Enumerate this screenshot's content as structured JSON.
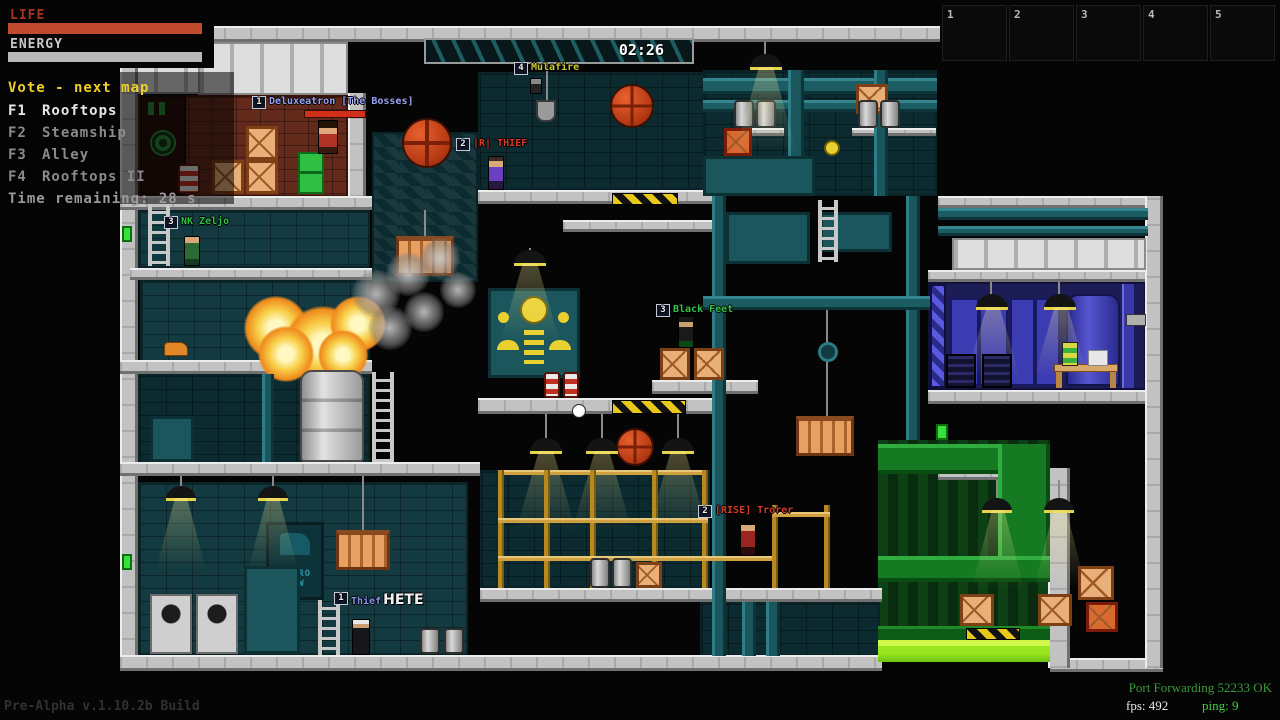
{
  "hud": {
    "life_label": "LIFE",
    "energy_label": "ENERGY",
    "timer": "02:26",
    "slots": [
      "1",
      "2",
      "3",
      "4",
      "5"
    ],
    "colors": {
      "life_bar": "#bf4a2e",
      "energy_bar": "#b9b9b9",
      "vote_title": "#f0d028",
      "acid_green": "#9ae620",
      "machine_teal": "#1a565c"
    }
  },
  "vote_menu": {
    "title": "Vote - next map",
    "options": [
      {
        "key": "F1",
        "label": "Rooftops"
      },
      {
        "key": "F2",
        "label": "Steamship"
      },
      {
        "key": "F3",
        "label": "Alley"
      },
      {
        "key": "F4",
        "label": "Rooftops II"
      }
    ],
    "time_remaining": "Time remaining: 28 s"
  },
  "players": [
    {
      "badge": "1",
      "name": "Deluxeatron [The Bosses]",
      "color": "#9aa4f4"
    },
    {
      "badge": "4",
      "name": "Mulafire",
      "color": "#c9c93a"
    },
    {
      "badge": "2",
      "name": "|R| THIEF",
      "color": "#d23b2a"
    },
    {
      "badge": "3",
      "name": "NK Zeljo",
      "color": "#35c04a"
    },
    {
      "badge": "3",
      "name": "Black Feet",
      "color": "#35c04a"
    },
    {
      "badge": "2",
      "name": "[RISE] Trorer",
      "color": "#d23b2a"
    },
    {
      "badge": "1",
      "name": "Thief",
      "color": "#8a94e8",
      "chat_overlay": "HETE"
    }
  ],
  "scene_text": {
    "poster_line1": "METRO",
    "poster_line2": "RAW"
  },
  "status": {
    "build": "Pre-Alpha v.1.10.2b Build",
    "port_forwarding": "Port Forwarding 52233 OK",
    "fps_label": "fps:",
    "fps_value": "492",
    "ping_label": "ping:",
    "ping_value": "9"
  }
}
